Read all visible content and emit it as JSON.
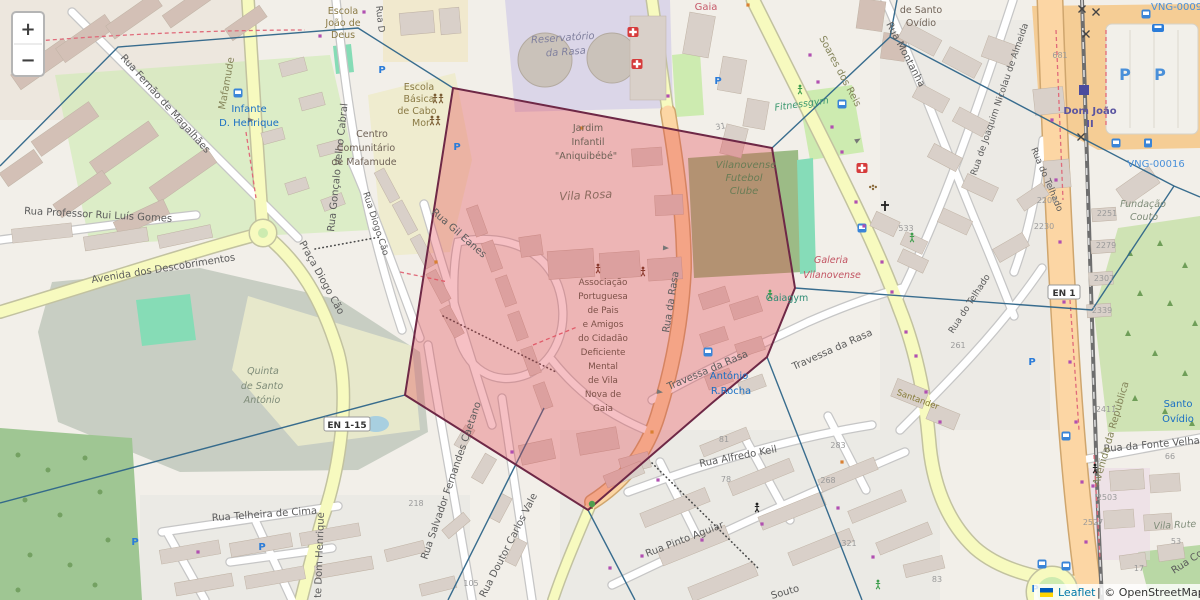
{
  "palette": {
    "region_fill": "#e23c46",
    "region_stroke": "#6e2846",
    "cell_line": "#2e6589",
    "road_yellow": "#f7fabf",
    "road_orange": "#fcd6a4",
    "accent_blue": "#2b7cd9"
  },
  "zoom_control": {
    "zoom_in": "+",
    "zoom_out": "−"
  },
  "attribution": {
    "leaflet": "Leaflet",
    "copyright": " | © OpenStreetMap"
  },
  "shields": {
    "en1_15": "EN 1-15",
    "en1": "EN 1"
  },
  "icons": {
    "parking_letter": "P"
  },
  "streets": {
    "fernao": "Rua Fernão de Magalhães",
    "goncalo": "Rua Gonçalo Velho Cabral",
    "ruad": "Rua D",
    "diogocao": "Rua Diogo Cão",
    "pracadiogo": "Praça Diogo Cão",
    "gileanes": "Rua Gil Eanes",
    "salvador": "Rua Salvador Fernandes Caetano",
    "carlosvale": "Rua Doutor Carlos Vale",
    "telheira": "Rua Telheira de Cima",
    "dhenrique": "te Dom Henrique",
    "ruigomes": "Rua Professor Rui Luís Gomes",
    "descobrimentos": "Avenida dos Descobrimentos",
    "alfredokeil": "Rua Alfredo Keil",
    "pintoaguiar": "Rua Pinto Aguiar",
    "souto": "Souto",
    "ruadarasa": "Rua da Rasa",
    "travessa1": "Travessa da Rasa",
    "travessa2": "Travessa da Rasa",
    "montanha": "Rua Montanha",
    "joaquim": "Rua de Joaquim Nicolau de Almeida",
    "telhado1": "Rua do Telhado",
    "telhado2": "Rua do Telhado",
    "fontevelha": "Rua da Fonte Velha",
    "ruaco": "Rua Co",
    "soares": "Soares dos Reis",
    "mafamude": "Mafamude",
    "avrepublica": "Avenida da República"
  },
  "places": {
    "escolajoao": [
      "Escola",
      "João de",
      "Deus"
    ],
    "cabomor": [
      "Escola",
      "Básica",
      "de Cabo",
      "Mor"
    ],
    "centro": [
      "Centro",
      "Comunitário",
      "de Mafamude"
    ],
    "quinta": [
      "Quinta",
      "de Santo",
      "António"
    ],
    "reserv": [
      "Reservatório",
      "da Rasa"
    ],
    "gaia": "Gaia",
    "ovidiotop": [
      "de Santo",
      "Ovídio"
    ],
    "jardim": [
      "Jardim",
      "Infantil",
      "\"Aniquibébé\""
    ],
    "vilarosa": "Vila Rosa",
    "vilanov": [
      "Vilanovense",
      "Futebol",
      "Clube"
    ],
    "fitness": "Fitnessgym",
    "galeria": [
      "Galeria",
      "Vilanovense"
    ],
    "gaiagym": "Gaiagym",
    "appacdm": [
      "Associação",
      "Portuguesa",
      "de Pais",
      "e Amigos",
      "do Cidadão",
      "Deficiente",
      "Mental",
      "de Vila",
      "Nova de",
      "Gaia"
    ],
    "santander": "Santander",
    "fundacao": [
      "Fundação",
      "Couto"
    ],
    "vilarute": "Vila Rute"
  },
  "transit": {
    "infante": [
      "Infante",
      "D. Henrique"
    ],
    "antonio": [
      "António",
      "R.Rocha"
    ],
    "domjoao": [
      "Dom João",
      "II"
    ],
    "santoovidio": [
      "Santo",
      "Ovídio"
    ],
    "vng9": "VNG-0009",
    "vng16": "VNG-00016"
  },
  "house_numbers": {
    "n31": "31",
    "n533": "533",
    "n261": "261",
    "n268": "268",
    "n283": "283",
    "n321": "321",
    "n81": "81",
    "n78": "78",
    "n105": "105",
    "n218": "218",
    "n681": "681",
    "n2208": "2208",
    "n2230": "2230",
    "n2251": "2251",
    "n2279": "2279",
    "n2307": "2307",
    "n2339": "2339",
    "n2411": "2411",
    "n2503": "2503",
    "n2527": "2527",
    "n66": "66",
    "n53": "53",
    "n17": "17",
    "n83": "83"
  }
}
